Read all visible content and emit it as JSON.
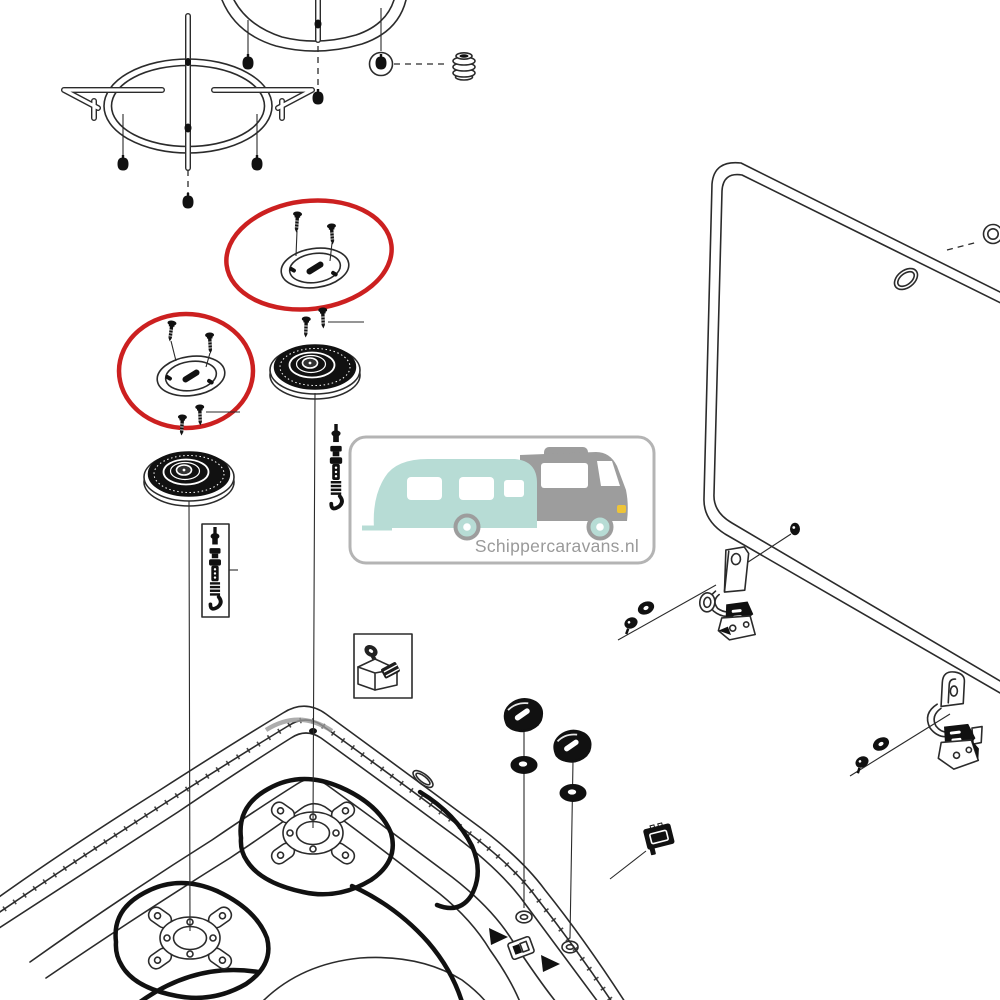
{
  "page": {
    "kind": "exploded-parts-diagram"
  },
  "watermark": {
    "text": "Schippercaravans.nl"
  },
  "highlights": {
    "shape": "ellipse",
    "count": 2
  },
  "colors": {
    "background": "#ffffff",
    "line": "#2b2b2b",
    "line_heavy": "#111111",
    "highlight_red": "#cc2020",
    "watermark_border": "#b4b4b4",
    "watermark_text": "#9a9a9a",
    "caravan_teal": "#b7dcd5",
    "vehicle_gray": "#9d9d9d",
    "headlight_yellow": "#eec437"
  },
  "parts": [
    "pan-support-left",
    "pan-support-top",
    "rubber-foot",
    "rubber-grommet",
    "burner-cap",
    "cap-screw",
    "burner-body",
    "thermocouple-boxed",
    "thermocouple",
    "ignition-clamp-box",
    "glass-lid",
    "lid-hole",
    "lid-pin",
    "lid-corner-grommet",
    "hinge-assembly-left",
    "hinge-assembly-right",
    "hinge-washer",
    "hinge-screw",
    "hob-body",
    "burner-mount-boss",
    "control-knob",
    "knob-nut",
    "o-ring",
    "ignition-switch",
    "position-arrow",
    "spark-connector"
  ]
}
